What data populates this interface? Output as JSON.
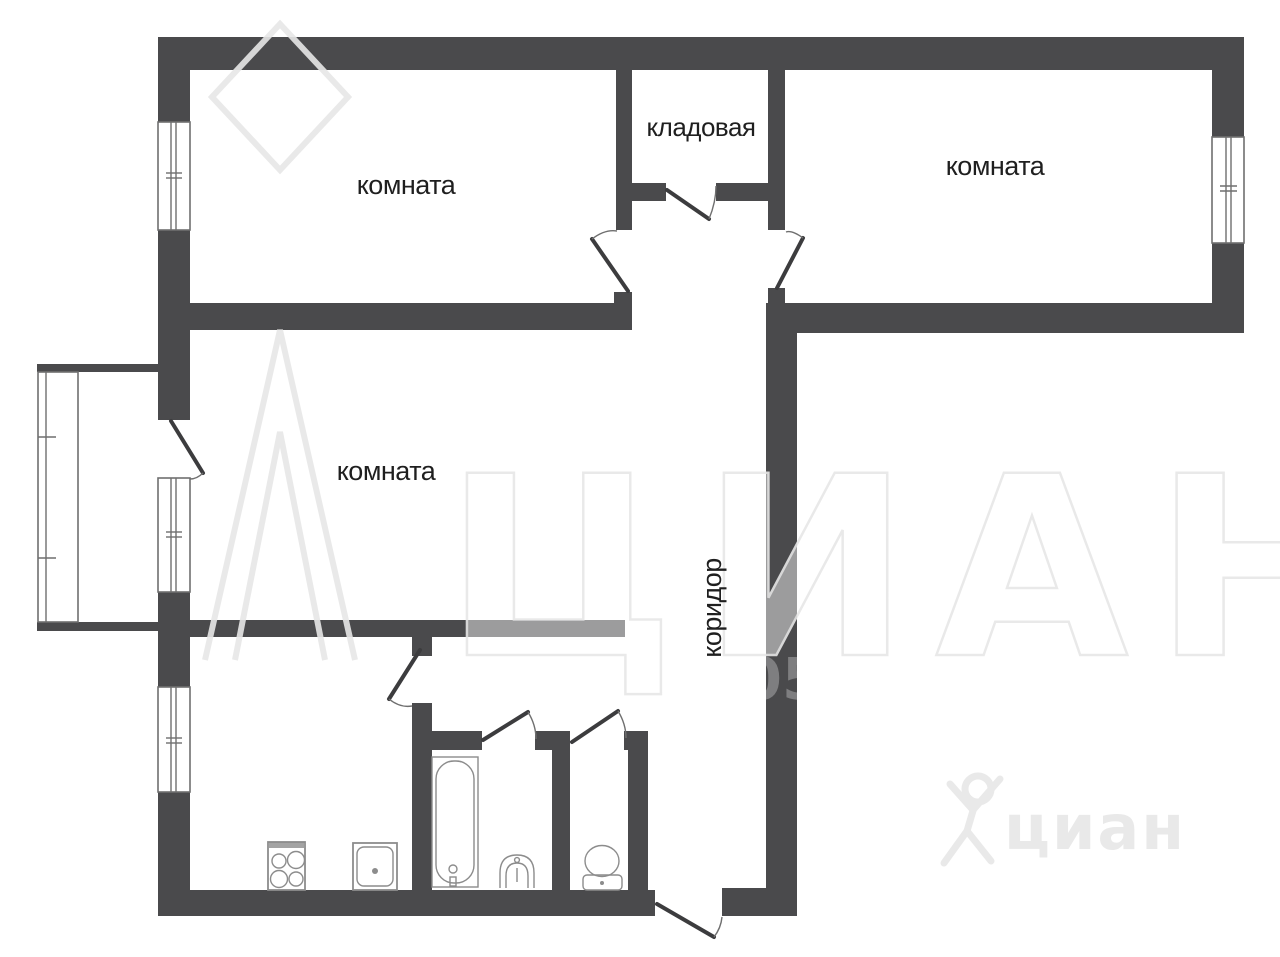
{
  "title": "apartment-floor-plan",
  "plan": {
    "rooms": [
      {
        "name": "room-top-left",
        "label": "комната"
      },
      {
        "name": "storage-room",
        "label": "кладовая"
      },
      {
        "name": "room-top-right",
        "label": "комната"
      },
      {
        "name": "room-middle-left",
        "label": "комната"
      },
      {
        "name": "corridor",
        "label": "коридор"
      }
    ],
    "fixture_icons": [
      "stove-icon",
      "kitchen-sink-icon",
      "bathtub-icon",
      "washbasin-icon",
      "toilet-icon"
    ],
    "window_count": 5,
    "door_count": 8,
    "has_balcony": true
  },
  "watermark": {
    "large_text": "ЦИАН",
    "digits": "05",
    "small_logo_text": "циан"
  },
  "colors": {
    "background": "#ffffff",
    "wall": "#4a4a4c",
    "label": "#1f1f1f",
    "door": "#3c3c3e",
    "frame": "#6f6f6f",
    "fixture": "#8c8c8c",
    "watermark": "#e7e7e7",
    "watermark-small": "#e9e9e9"
  }
}
